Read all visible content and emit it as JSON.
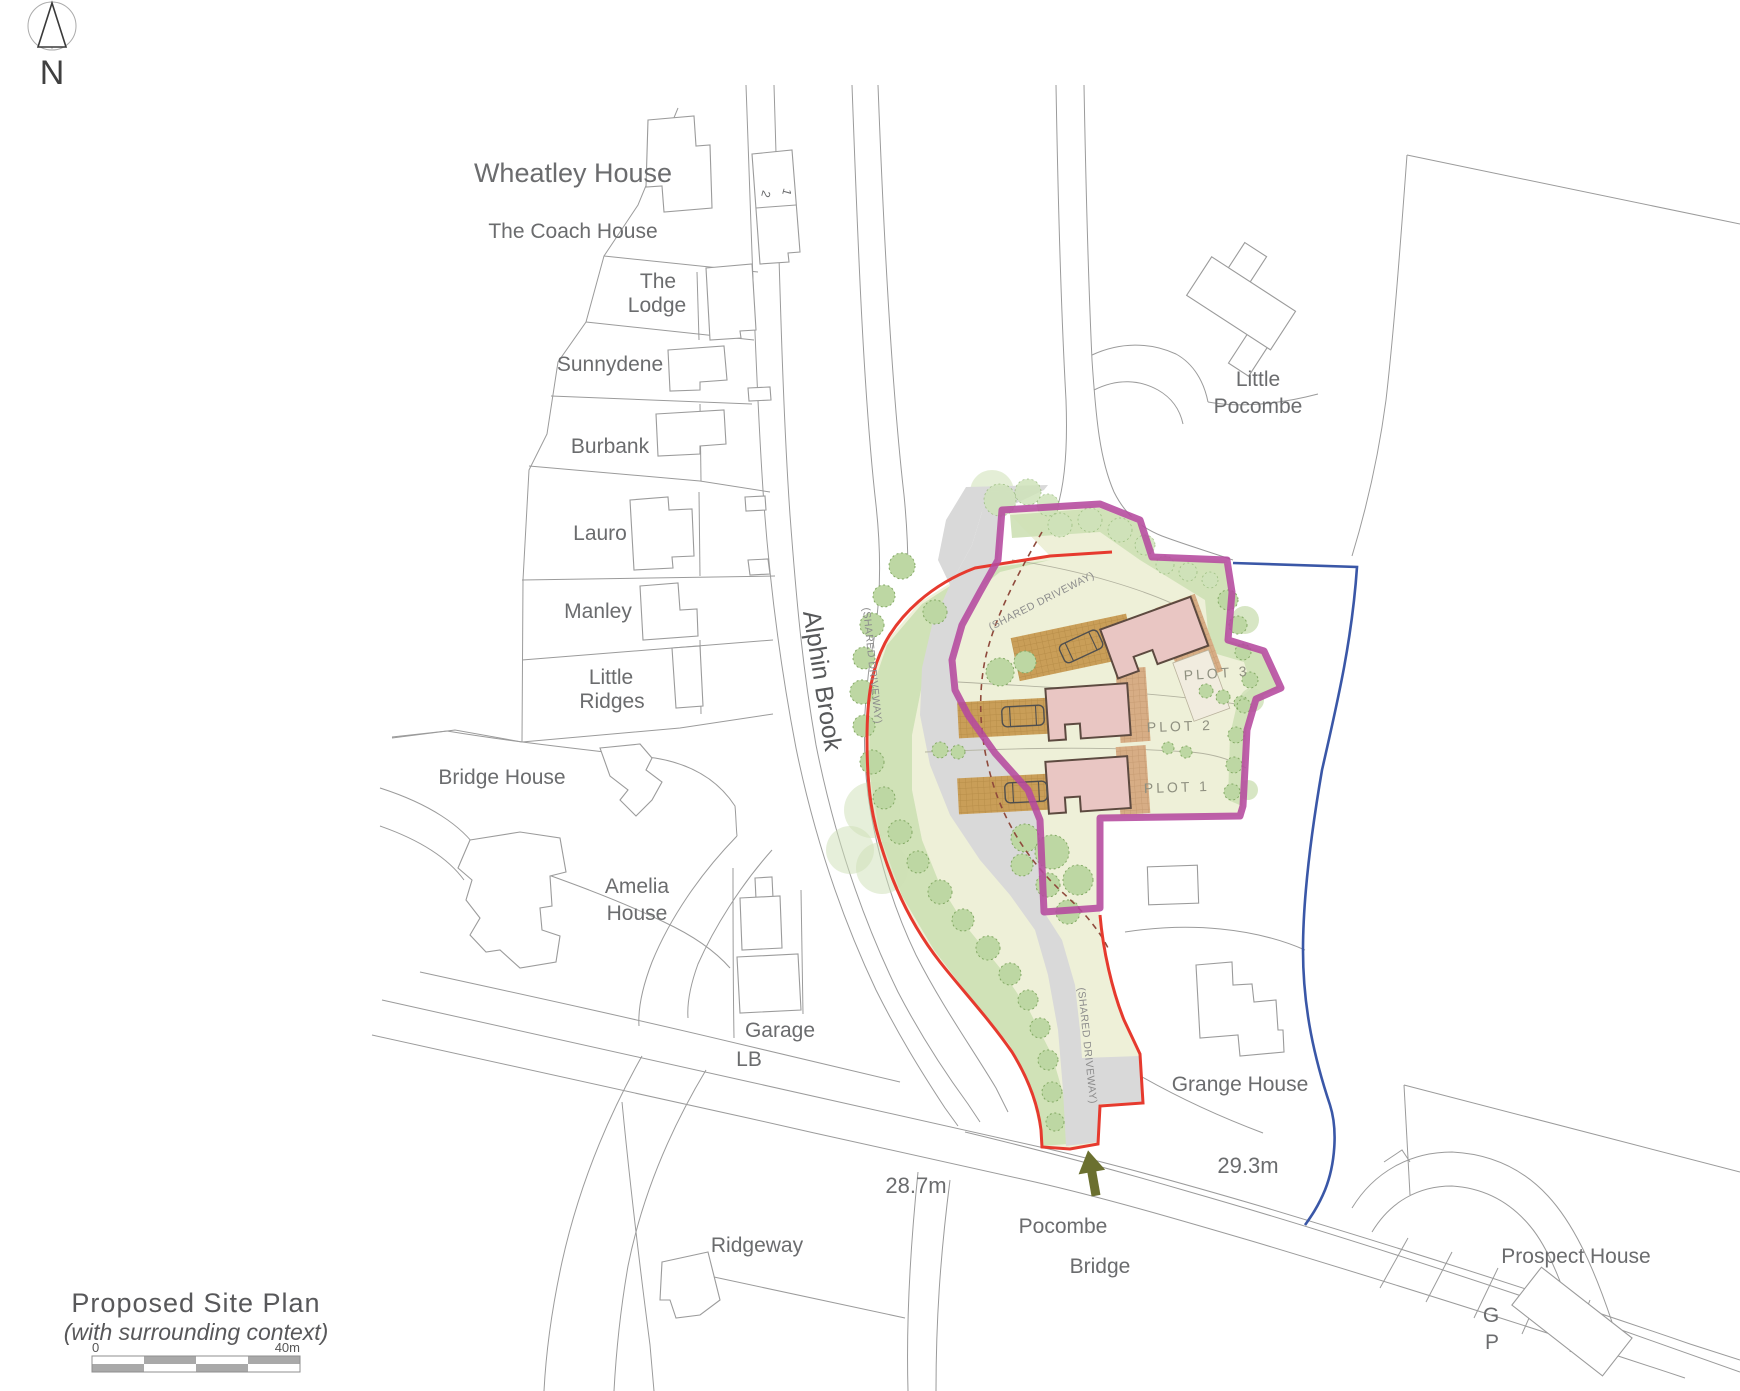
{
  "compass": {
    "north_label": "N"
  },
  "title_block": {
    "title": "Proposed Site Plan",
    "subtitle": "(with surrounding context)",
    "scale_zero_label": "0",
    "scale_end_label": "40m"
  },
  "annotations": {
    "road_spot_height": "28.7m",
    "field_spot_height": "29.3m"
  },
  "site": {
    "plot_labels": [
      "PLOT 1",
      "PLOT 2",
      "PLOT 3"
    ],
    "shared_driveway_labels": [
      "(SHARED DRIVEWAY)",
      "(SHARED DRIVEWAY)",
      "(SHARED DRIVEWAY)"
    ]
  },
  "context_labels": {
    "wheatley_house": "Wheatley House",
    "coach_house": "The Coach House",
    "lodge": [
      "The",
      "Lodge"
    ],
    "sunnydene": "Sunnydene",
    "burbank": "Burbank",
    "lauro": "Lauro",
    "manley": "Manley",
    "little_ridges": [
      "Little",
      "Ridges"
    ],
    "bridge_house": "Bridge House",
    "amelia_house": [
      "Amelia",
      "House"
    ],
    "garage": "Garage",
    "lb": "LB",
    "ridgeway": "Ridgeway",
    "little_pocombe": [
      "Little",
      "Pocombe"
    ],
    "grange_house": "Grange House",
    "prospect_house": "Prospect House",
    "pocombe_bridge": [
      "Pocombe",
      "Bridge"
    ],
    "alphin_brook": "Alphin Brook",
    "gp": [
      "G",
      "P"
    ],
    "house_number_2": "2",
    "house_number_1": "1"
  },
  "colors": {
    "site_boundary_purple": "#b5499e",
    "application_boundary_red": "#e63a2e",
    "context_boundary_blue": "#3a57a7",
    "site_fill": "#eef0d8",
    "landscape_green": "#cde0b5",
    "tree_green": "#bdd7a3",
    "driveway_grey": "#d9d9d9",
    "paving_tan": "#c99e58",
    "house_pink": "#e9c6c3",
    "house_outline_brown": "#5d4a40",
    "entrance_arrow_olive": "#6b7030",
    "context_line_grey": "#9b9b9b",
    "label_grey": "#6b6c6e"
  }
}
